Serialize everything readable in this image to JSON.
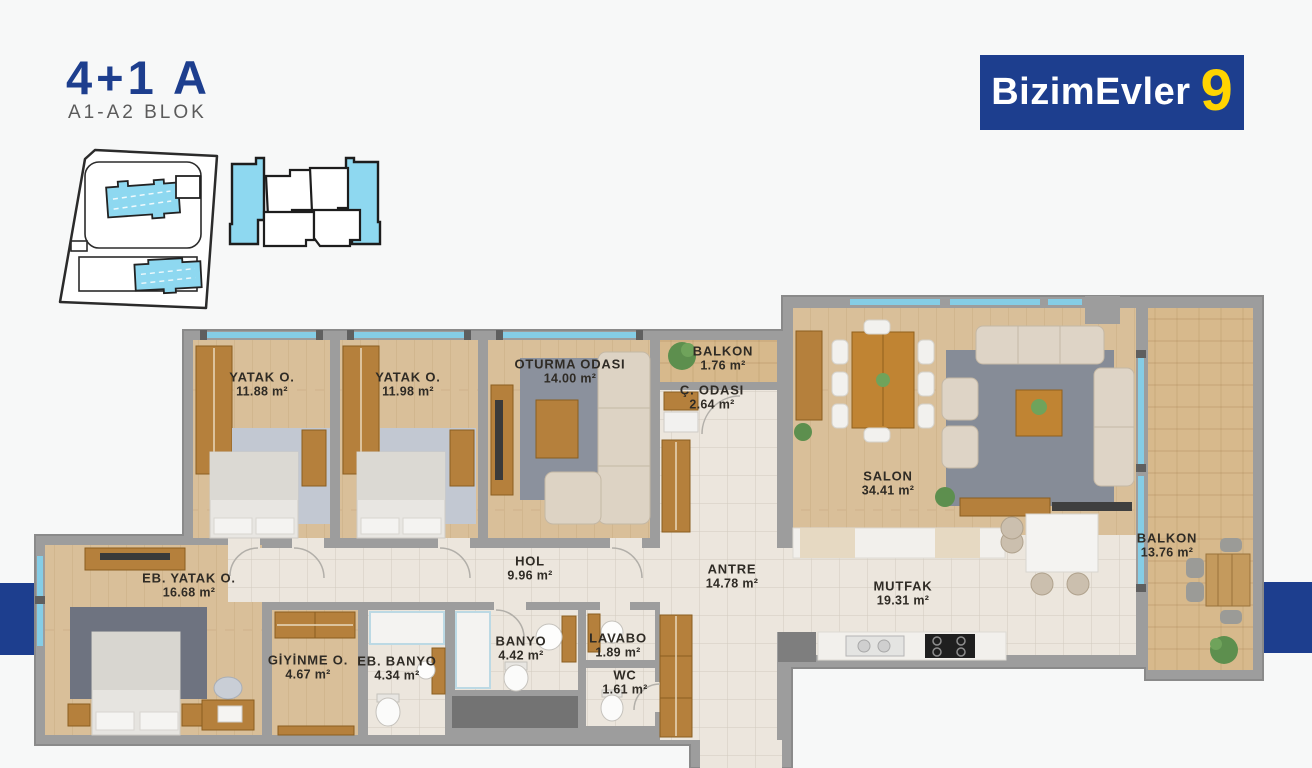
{
  "header": {
    "unit_type": "4+1 A",
    "block": "A1-A2  BLOK"
  },
  "logo": {
    "brand": "BizimEvler",
    "number": "9"
  },
  "icons": {
    "site_plan": "site-plan-icon",
    "block_plan": "block-plan-icon"
  },
  "colors": {
    "accent_blue": "#1d3e8e",
    "accent_yellow": "#ffd400",
    "site_building_blue": "#8ed8f0",
    "window_blue": "#85cde6",
    "wall_gray": "#9d9d9d",
    "wood_floor": "#d9bf99",
    "tile_floor": "#ece6dd",
    "deck_floor": "#d7b98c"
  },
  "rooms": [
    {
      "name": "YATAK O.",
      "area": "11.88 m²"
    },
    {
      "name": "YATAK O.",
      "area": "11.98 m²"
    },
    {
      "name": "OTURMA ODASI",
      "area": "14.00 m²"
    },
    {
      "name": "BALKON",
      "area": "1.76 m²"
    },
    {
      "name": "Ç. ODASI",
      "area": "2.64 m²"
    },
    {
      "name": "SALON",
      "area": "34.41 m²"
    },
    {
      "name": "BALKON",
      "area": "13.76 m²"
    },
    {
      "name": "EB. YATAK O.",
      "area": "16.68 m²"
    },
    {
      "name": "HOL",
      "area": "9.96 m²"
    },
    {
      "name": "ANTRE",
      "area": "14.78 m²"
    },
    {
      "name": "MUTFAK",
      "area": "19.31 m²"
    },
    {
      "name": "GİYİNME O.",
      "area": "4.67 m²"
    },
    {
      "name": "EB. BANYO",
      "area": "4.34 m²"
    },
    {
      "name": "BANYO",
      "area": "4.42 m²"
    },
    {
      "name": "LAVABO",
      "area": "1.89 m²"
    },
    {
      "name": "WC",
      "area": "1.61 m²"
    }
  ]
}
